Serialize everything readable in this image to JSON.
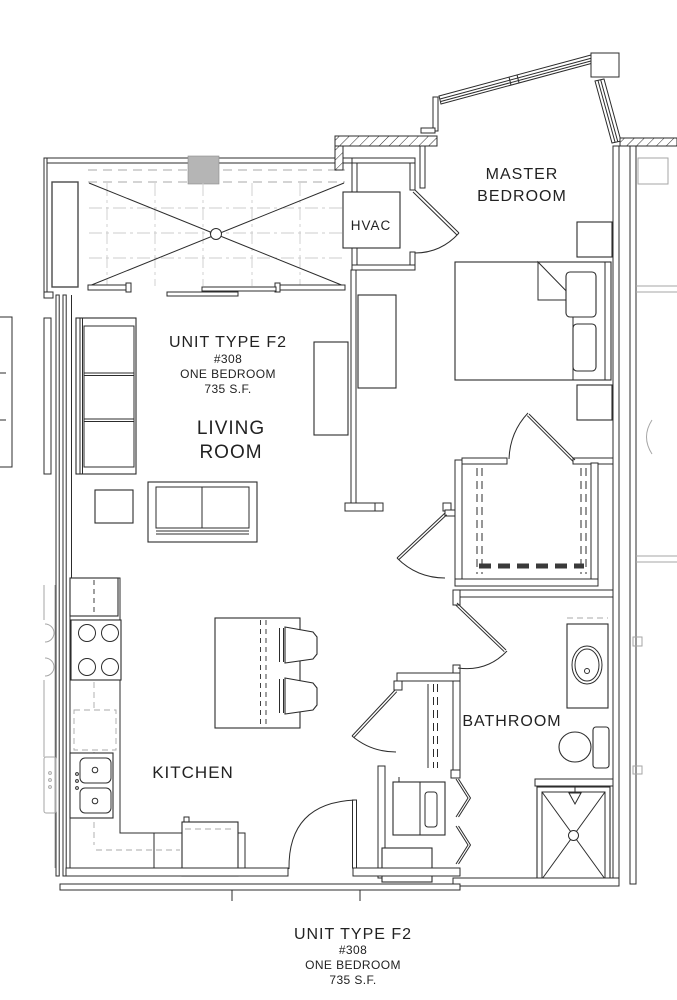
{
  "title_top": {
    "title": "UNIT TYPE F2",
    "unit": "#308",
    "type": "ONE BEDROOM",
    "area": "735 S.F."
  },
  "title_bottom": {
    "title": "UNIT TYPE F2",
    "unit": "#308",
    "type": "ONE BEDROOM",
    "area": "735 S.F."
  },
  "rooms": {
    "living_line1": "LIVING",
    "living_line2": "ROOM",
    "master_line1": "MASTER",
    "master_line2": "BEDROOM",
    "kitchen": "KITCHEN",
    "bathroom": "BATHROOM",
    "hvac": "HVAC"
  },
  "colors": {
    "line": "#2c2c2c",
    "grid": "#cdcdcd",
    "neighbor": "#a6a6a6",
    "shade": "#b5b5b5"
  }
}
